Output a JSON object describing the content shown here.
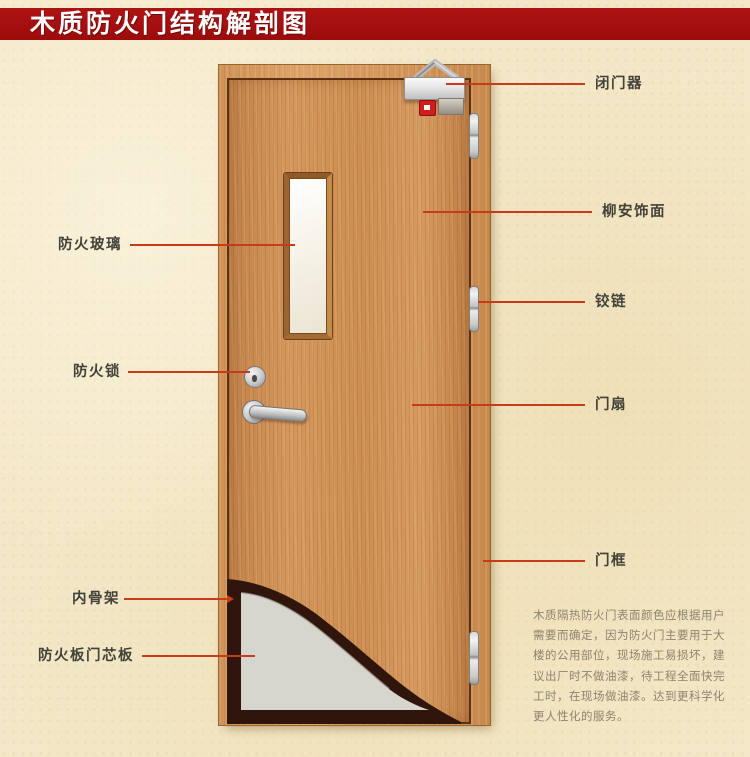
{
  "title": "木质防火门结构解剖图",
  "callouts": {
    "fire_glass": {
      "label": "防火玻璃"
    },
    "fire_lock": {
      "label": "防火锁"
    },
    "inner_frame": {
      "label": "内骨架"
    },
    "core_panel": {
      "label": "防火板门芯板"
    },
    "door_closer": {
      "label": "闭门器"
    },
    "veneer": {
      "label": "柳安饰面"
    },
    "hinge": {
      "label": "铰链"
    },
    "door_leaf": {
      "label": "门扇"
    },
    "door_frame": {
      "label": "门框"
    }
  },
  "description": {
    "lines": [
      "木质隔热防火门表面颜色应根据用户",
      "需要而确定，因为防火门主要用于大",
      "楼的公用部位，现场施工易损坏，建",
      "议出厂时不做油漆，待工程全面快完",
      "工时，在现场做油漆。达到更科学化",
      "更人性化的服务。"
    ]
  },
  "colors": {
    "banner_red": "#a40f0f",
    "background_beige": "#f3e7c7",
    "callout_line_red": "#c93a18",
    "label_text": "#42423a",
    "door_wood": "#cd8e52",
    "core_panel_gray": "#d6d5ce",
    "inner_frame_dark": "#2f150c",
    "glass_white": "#f6f3e8"
  }
}
